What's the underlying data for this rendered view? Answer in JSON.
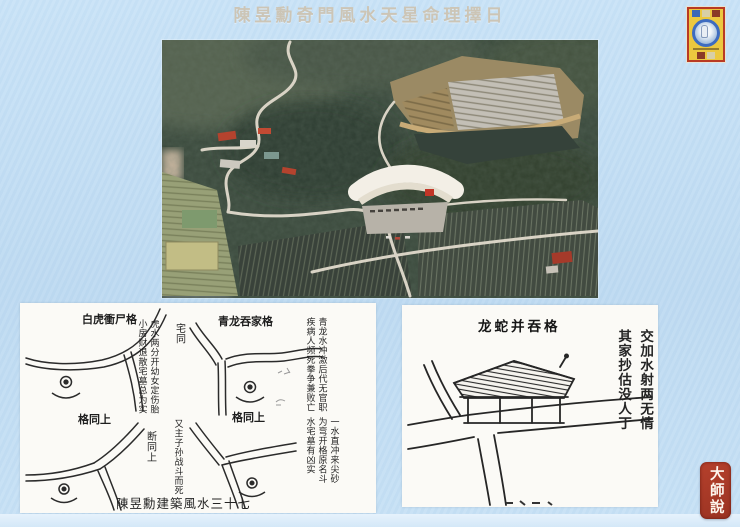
{
  "slide": {
    "title": "陳昱勳奇門風水天星命理擇日",
    "background_color": "#c4def2",
    "footer_band_color": "#d9ebf9",
    "title_color": "#ccc5b6"
  },
  "seal": {
    "text": "大師說",
    "color": "#a93a28"
  },
  "emblem": {
    "name": "buddhist-thangka-miniature",
    "frame_color": "#b93a24",
    "field_color": "#ecc83f"
  },
  "aerial_photo": {
    "description": "aerial view of forested valley with winding roads, terraced clearing, large white building and striped farm fields"
  },
  "left_figure": {
    "caption": "陳昱勳建築風水三十七",
    "diagram1": {
      "title": "白虎衝尸格",
      "note_col_right": "虎水两分开幼女定伤胎",
      "note_col_left": "小房财退散宅墓总为实",
      "side_note": "宅同"
    },
    "diagram2": {
      "title": "青龙吞家格",
      "note_col_right": "青龙水冲激后代无官职",
      "note_col_left": "疾病人频死拳争兼败亡"
    },
    "diagram3": {
      "title": "格同上",
      "note_col_right": "又主子孙战斗而死",
      "note_col_left": "断同上"
    },
    "diagram4": {
      "title": "格同上",
      "note_col_1": "一水直冲来尖砂",
      "note_col_2": "为弯开格原名斗",
      "note_col_3": "水宅墓有凶实"
    }
  },
  "right_figure": {
    "title": "龙蛇并吞格",
    "note_col_right": "交加水射两无情",
    "note_col_left": "其家抄估没人丁"
  }
}
